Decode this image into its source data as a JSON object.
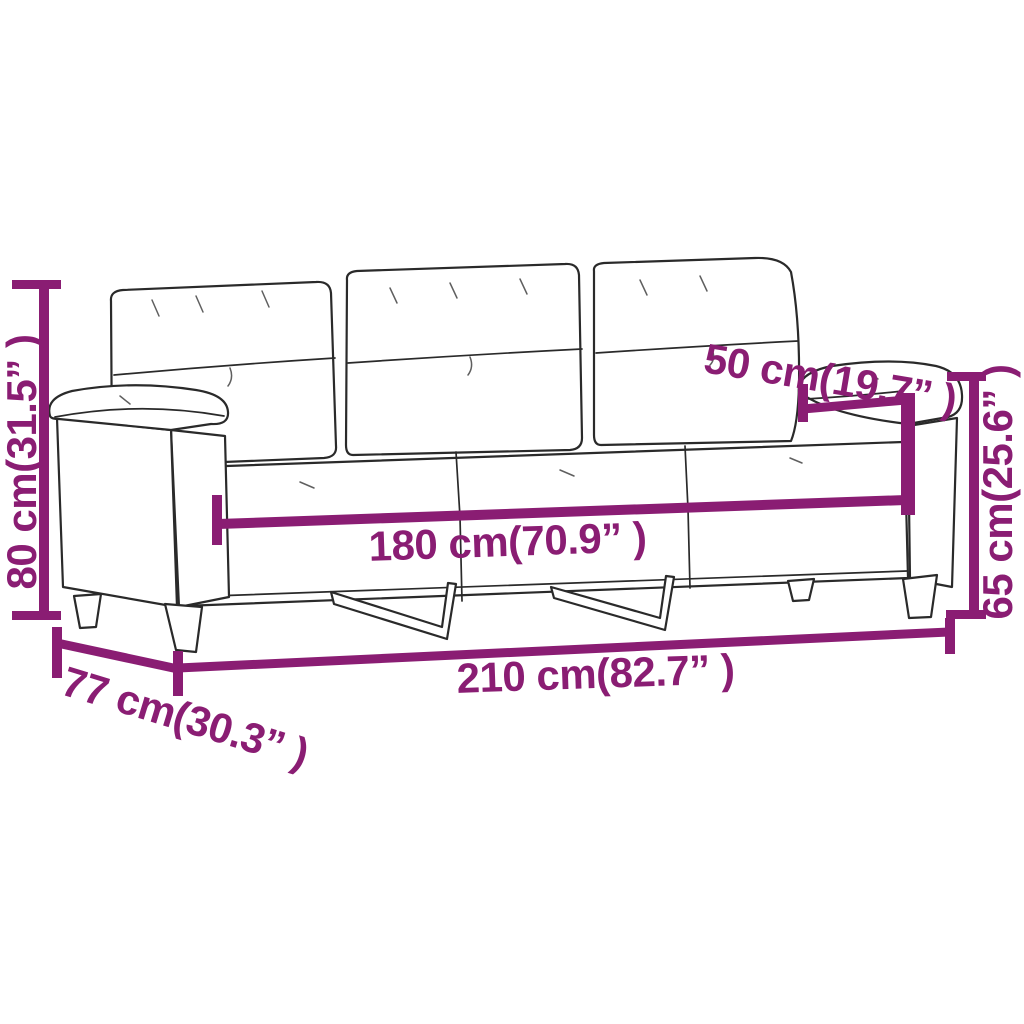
{
  "meta": {
    "title": "Three-seater sofa dimension diagram",
    "product": "3-seater sofa",
    "units": "cm (inches)"
  },
  "style": {
    "accent": "#8a1d73",
    "line": "#2a2a2a",
    "background": "#ffffff"
  },
  "dimensions": {
    "height": {
      "name": "overall height",
      "label": "80 cm(31.5” )",
      "cm": 80,
      "inch": 31.5
    },
    "depth": {
      "name": "overall depth",
      "label": "77 cm(30.3” )",
      "cm": 77,
      "inch": 30.3
    },
    "width_total": {
      "name": "overall width",
      "label": "210 cm(82.7” )",
      "cm": 210,
      "inch": 82.7
    },
    "width_seat": {
      "name": "inner seat width",
      "label": "180 cm(70.9” )",
      "cm": 180,
      "inch": 70.9
    },
    "seat_depth": {
      "name": "seat depth",
      "label": "50 cm(19.7” )",
      "cm": 50,
      "inch": 19.7
    },
    "arm_height": {
      "name": "armrest height",
      "label": "65 cm(25.6” )",
      "cm": 65,
      "inch": 25.6
    }
  }
}
